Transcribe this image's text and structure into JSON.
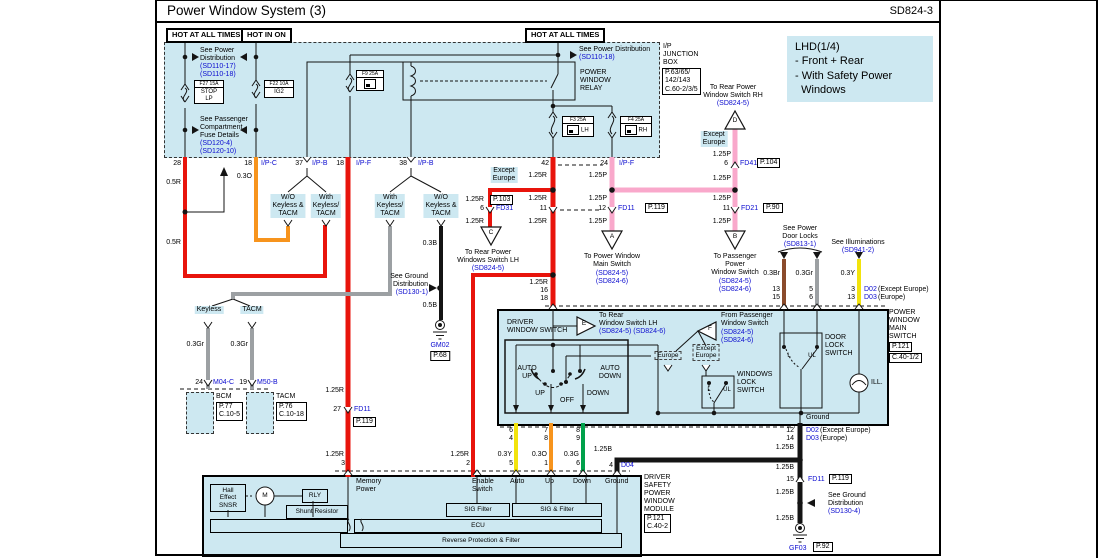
{
  "header": {
    "title": "Power Window System (3)",
    "code": "SD824-3"
  },
  "hot": {
    "a": "HOT AT ALL TIMES",
    "b": "HOT IN ON",
    "c": "HOT AT ALL TIMES"
  },
  "jb": {
    "name": "I/P\nJUNCTION\nBOX",
    "ref": "P.63/65/\n142/143\nC.60-2/3/5",
    "see_pd_left": "See Power\nDistribution",
    "pd17": "(SD110-17)",
    "pd18": "(SD110-18)",
    "see_pd_right": "See Power Distribution",
    "see_fuse": "See Passenger\nCompartment\nFuse Details",
    "sd120_4": "(SD120-4)",
    "sd120_10": "(SD120-10)",
    "f27": "F27 15A",
    "f27n": "STOP\nLP",
    "f22": "F22 10A",
    "f22n": "IG2",
    "f9": "F9 25A",
    "relay": "POWER\nWINDOW\nRELAY",
    "f3": "F3 25A",
    "f3n": "LH",
    "f4": "F4 25A",
    "f4n": "RH"
  },
  "note": {
    "text": "LHD(1/4)\n- Front + Rear\n- With Safety Power\n  Windows"
  },
  "pins": {
    "p28": "28",
    "p18c": "18",
    "ipc": "I/P-C",
    "p37": "37",
    "ipb": "I/P-B",
    "p18f": "18",
    "ipf": "I/P-F",
    "p38": "38",
    "ipb2": "I/P-B",
    "p42": "42",
    "p24": "24",
    "ipf2": "I/P-F"
  },
  "gauge": {
    "r05": "0.5R",
    "o03": "0.3O",
    "r125": "1.25R",
    "p125": "1.25P",
    "b03": "0.3B",
    "b05": "0.5B",
    "gr03": "0.3Gr",
    "br03": "0.3Br",
    "y03": "0.3Y",
    "g03": "0.3G",
    "b125": "1.25B"
  },
  "variant": {
    "wo": "W/O\nKeyless &\nTACM",
    "with": "With\nKeyless/\nTACM",
    "keyless": "Keyless",
    "tacm": "TACM",
    "exc": "Except\nEurope",
    "eur": "Europe"
  },
  "kt": {
    "p24": "24",
    "m04": "M04-C",
    "bcm": "BCM",
    "bcmref": "P.77\nC.10-5",
    "p19": "19",
    "m50": "M50-B",
    "tacm": "TACM",
    "tacmref": "P.76\nC.10-18"
  },
  "gnd": {
    "see1": "See Ground\nDistribution",
    "sd1": "(SD130-1)",
    "gm02": "GM02",
    "p68": "P.68",
    "see4": "See Ground\nDistribution",
    "sd4": "(SD130-4)",
    "gf03": "GF03",
    "p92": "P.92"
  },
  "fd": {
    "n27": "27",
    "fd11": "FD11",
    "p119": "P.119",
    "n6": "6",
    "fd31": "FD31",
    "p103": "P.103",
    "n11": "11",
    "n12": "12",
    "fd21": "FD21",
    "p90": "P.90",
    "n6b": "6",
    "fd41": "FD41",
    "p104": "P.104",
    "n15": "15"
  },
  "tri": {
    "a": "A",
    "b": "B",
    "c": "C",
    "d": "D",
    "e": "E",
    "f": "F",
    "at": "To Power Window\nMain Switch",
    "bt": "To Passenger\nPower\nWindow Switch",
    "ct": "To Rear Power\nWindows Switch LH",
    "dt": "To Rear Power\nWindow Switch RH",
    "et": "To Rear\nWindow Switch LH",
    "ft": "From Passenger\nWindow Switch",
    "sd5": "(SD824-5)",
    "sd6": "(SD824-6)",
    "sd56": "(SD824-5) (SD824-6)"
  },
  "right": {
    "doorlocks": "See Power\nDoor Locks",
    "sd813": "(SD813-1)",
    "illum": "See Illuminations",
    "sd941": "(SD941-2)",
    "d02": "D02",
    "d03": "D03",
    "exc": "(Except Europe)",
    "eur": "(Europe)"
  },
  "ms": {
    "title": "POWER\nWINDOW\nMAIN\nSWITCH",
    "ref1": "P.121",
    "ref2": "C.40-1/2",
    "driver": "DRIVER\nWINDOW SWITCH",
    "autoup": "AUTO\nUP",
    "up": "UP",
    "off": "OFF",
    "down": "DOWN",
    "autodown": "AUTO\nDOWN",
    "wls": "WINDOWS\nLOCK\nSWITCH",
    "dls": "DOOR\nLOCK\nSWITCH",
    "l": "L",
    "ul": "UL",
    "ill": "ILL.",
    "ground": "Ground",
    "p16": "16",
    "p18": "18",
    "p13": "13",
    "p15": "15",
    "p5": "5",
    "p6": "6",
    "p3": "3",
    "p13b": "13",
    "b6": "6",
    "b4": "4",
    "b7": "7",
    "b8": "8",
    "b8b": "8",
    "b9": "9",
    "b12": "12",
    "b14": "14"
  },
  "mod": {
    "title": "DRIVER\nSAFETY\nPOWER\nWINDOW\nMODULE",
    "ref": "P.121\nC.40-2",
    "mem": "Memory\nPower",
    "en": "Enable\nSwitch",
    "auto": "Auto",
    "upl": "Up",
    "downl": "Down",
    "gndl": "Ground",
    "hall": "Hall\nEffect\nSNSR",
    "m": "M",
    "rly": "RLY",
    "shunt": "Shunt Resistor",
    "sig1": "SIG Filter",
    "sig2": "SIG & Filter",
    "ecu": "ECU",
    "rev": "Reverse Protection & Filter",
    "n3": "3",
    "n2": "2",
    "n5": "5",
    "n1": "1",
    "n6": "6",
    "n4": "4",
    "d04": "D04"
  },
  "colors": {
    "wire_red": "#e8140c",
    "wire_orange": "#f7941d",
    "wire_pink": "#f9a8cb",
    "wire_yellow": "#f2e30c",
    "wire_green": "#00a14b",
    "wire_gray": "#9ca0a3",
    "wire_brown": "#8a4b2b",
    "wire_black": "#141414",
    "panel_blue": "#cde8f1",
    "ref_blue": "#0b0bcf"
  }
}
